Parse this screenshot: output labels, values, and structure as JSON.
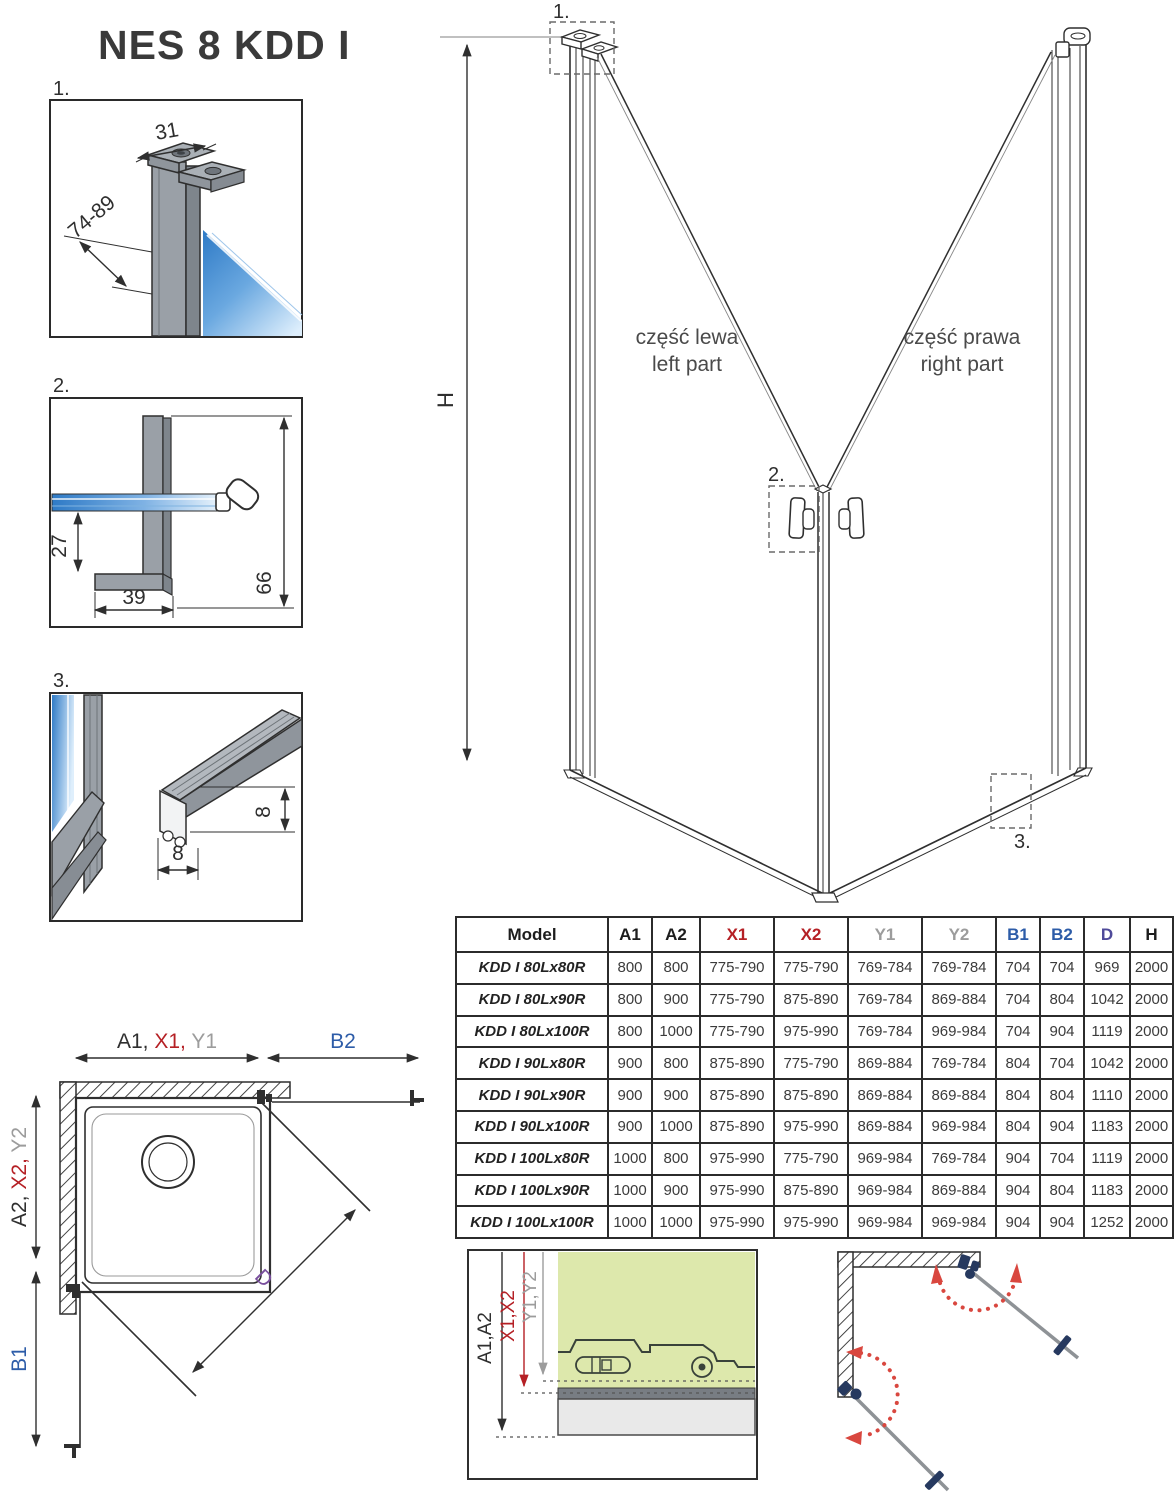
{
  "title": "NES 8 KDD I",
  "colors": {
    "ink": "#2f2f2f",
    "red": "#b52025",
    "grayc": "#9c9c9c",
    "blue": "#2d5ca8",
    "purple": "#7a4f9e",
    "tabled": "#4f4a9a",
    "arcred": "#d9473f",
    "navy": "#26395f",
    "green": "#dde8ac",
    "glassdark": "#2e7ac6",
    "glasslight": "#ddeefc"
  },
  "details": {
    "d1": {
      "label": "1.",
      "width": "31",
      "depth": "74-89"
    },
    "d2": {
      "label": "2.",
      "height": "27",
      "width": "39",
      "total": "66"
    },
    "d3": {
      "label": "3.",
      "height": "8",
      "width": "8"
    }
  },
  "main": {
    "marker1": "1.",
    "marker2": "2.",
    "marker3": "3.",
    "height": "H",
    "left_pl": "część lewa",
    "left_en": "left part",
    "right_pl": "część prawa",
    "right_en": "right part"
  },
  "table": {
    "headers": [
      "Model",
      "A1",
      "A2",
      "X1",
      "X2",
      "Y1",
      "Y2",
      "B1",
      "B2",
      "D",
      "H"
    ],
    "rows": [
      {
        "model": "KDD I 80Lx80R",
        "a1": "800",
        "a2": "800",
        "x1": "775-790",
        "x2": "775-790",
        "y1": "769-784",
        "y2": "769-784",
        "b1": "704",
        "b2": "704",
        "d": "969",
        "h": "2000"
      },
      {
        "model": "KDD I 80Lx90R",
        "a1": "800",
        "a2": "900",
        "x1": "775-790",
        "x2": "875-890",
        "y1": "769-784",
        "y2": "869-884",
        "b1": "704",
        "b2": "804",
        "d": "1042",
        "h": "2000"
      },
      {
        "model": "KDD I 80Lx100R",
        "a1": "800",
        "a2": "1000",
        "x1": "775-790",
        "x2": "975-990",
        "y1": "769-784",
        "y2": "969-984",
        "b1": "704",
        "b2": "904",
        "d": "1119",
        "h": "2000"
      },
      {
        "model": "KDD I 90Lx80R",
        "a1": "900",
        "a2": "800",
        "x1": "875-890",
        "x2": "775-790",
        "y1": "869-884",
        "y2": "769-784",
        "b1": "804",
        "b2": "704",
        "d": "1042",
        "h": "2000"
      },
      {
        "model": "KDD I 90Lx90R",
        "a1": "900",
        "a2": "900",
        "x1": "875-890",
        "x2": "875-890",
        "y1": "869-884",
        "y2": "869-884",
        "b1": "804",
        "b2": "804",
        "d": "1110",
        "h": "2000"
      },
      {
        "model": "KDD I 90Lx100R",
        "a1": "900",
        "a2": "1000",
        "x1": "875-890",
        "x2": "975-990",
        "y1": "869-884",
        "y2": "969-984",
        "b1": "804",
        "b2": "904",
        "d": "1183",
        "h": "2000"
      },
      {
        "model": "KDD I 100Lx80R",
        "a1": "1000",
        "a2": "800",
        "x1": "975-990",
        "x2": "775-790",
        "y1": "969-984",
        "y2": "769-784",
        "b1": "904",
        "b2": "704",
        "d": "1119",
        "h": "2000"
      },
      {
        "model": "KDD I 100Lx90R",
        "a1": "1000",
        "a2": "900",
        "x1": "975-990",
        "x2": "875-890",
        "y1": "969-984",
        "y2": "869-884",
        "b1": "904",
        "b2": "804",
        "d": "1183",
        "h": "2000"
      },
      {
        "model": "KDD I 100Lx100R",
        "a1": "1000",
        "a2": "1000",
        "x1": "975-990",
        "x2": "975-990",
        "y1": "969-984",
        "y2": "969-984",
        "b1": "904",
        "b2": "904",
        "d": "1252",
        "h": "2000"
      }
    ]
  },
  "plan": {
    "a1": "A1, ",
    "x1": "X1, ",
    "y1": "Y1",
    "b2": "B2",
    "a2": "A2, ",
    "x2": "X2, ",
    "y2": "Y2",
    "b1": "B1",
    "d": "D"
  },
  "install": {
    "a": "A1,A2",
    "x": "X1,X2",
    "y": "Y1,Y2"
  }
}
